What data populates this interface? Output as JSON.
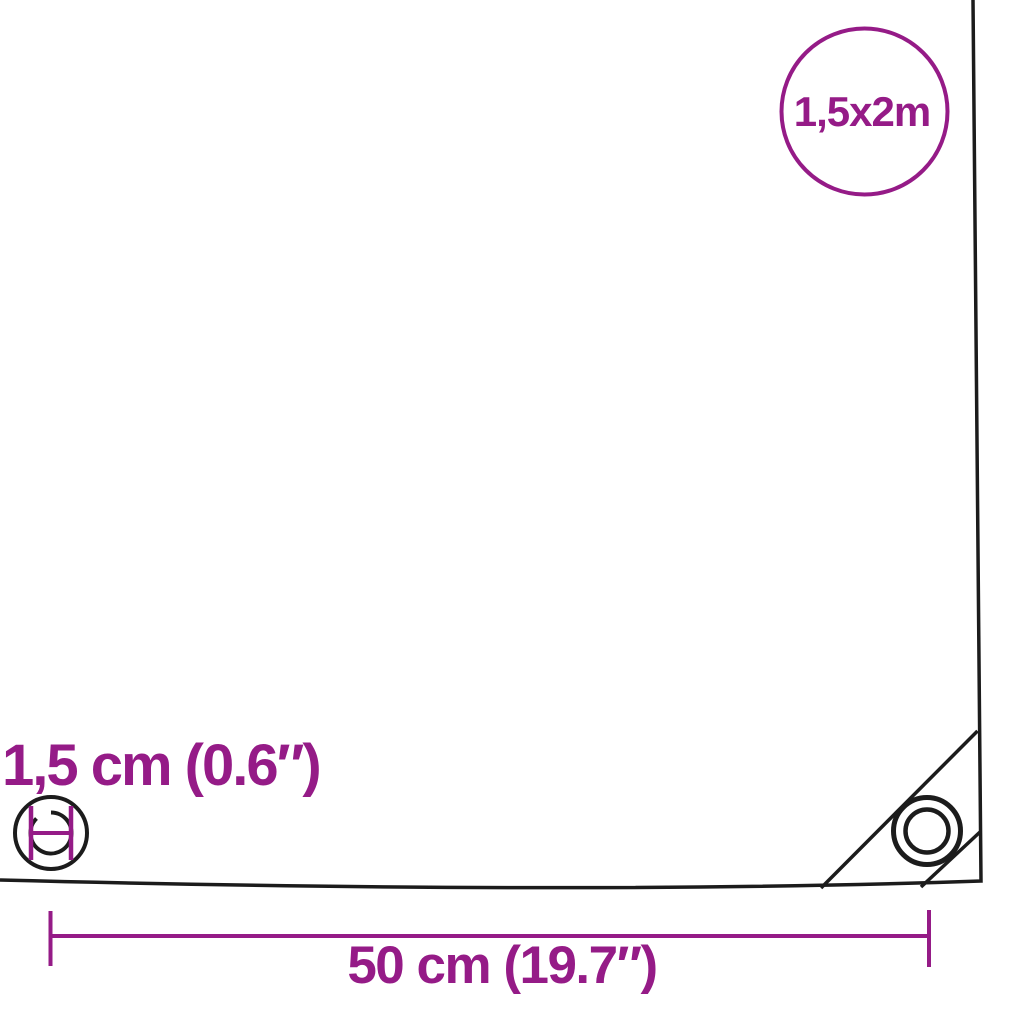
{
  "diagram": {
    "size_badge": {
      "label": "1,5x2m"
    },
    "eyelet_diameter": {
      "label": "1,5 cm (0.6″)"
    },
    "eyelet_spacing": {
      "label": "50 cm (19.7″)"
    },
    "colors": {
      "accent": "#951b87",
      "line": "#1c1c1c",
      "background": "#ffffff"
    }
  }
}
